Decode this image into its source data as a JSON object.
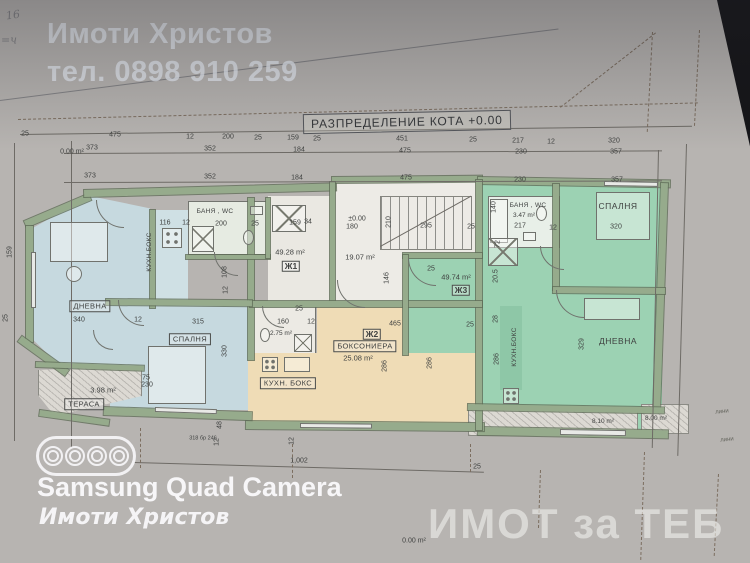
{
  "watermarks": {
    "agency": "Имоти Христов",
    "phone": "тел. 0898 910 259",
    "camera_caption": "Samsung Quad Camera",
    "camera_subcaption": "Имоти Христов",
    "corner_watermark": "ИМОТ за ТЕБ"
  },
  "colors": {
    "room_blue": "#c6d9df",
    "room_blue_light": "#cfe0e4",
    "room_green": "#9cd2b3",
    "room_green_dark": "#8ec7a7",
    "room_tan": "#efdcb6",
    "wall_sage": "#96ab8c",
    "background": "#141417"
  },
  "plan": {
    "title": "РАЗПРЕДЕЛЕНИЕ КОТА +0.00",
    "labels": [
      {
        "t": "25",
        "x": 25,
        "y": 134
      },
      {
        "t": "475",
        "x": 115,
        "y": 135
      },
      {
        "t": "12",
        "x": 190,
        "y": 137
      },
      {
        "t": "200",
        "x": 228,
        "y": 137
      },
      {
        "t": "25",
        "x": 258,
        "y": 138
      },
      {
        "t": "159",
        "x": 293,
        "y": 138
      },
      {
        "t": "25",
        "x": 317,
        "y": 139
      },
      {
        "t": "451",
        "x": 402,
        "y": 139
      },
      {
        "t": "25",
        "x": 473,
        "y": 140
      },
      {
        "t": "217",
        "x": 518,
        "y": 141
      },
      {
        "t": "12",
        "x": 551,
        "y": 142
      },
      {
        "t": "320",
        "x": 614,
        "y": 141
      },
      {
        "t": "0.00 m²",
        "x": 72,
        "y": 152
      },
      {
        "t": "373",
        "x": 92,
        "y": 148
      },
      {
        "t": "352",
        "x": 210,
        "y": 149
      },
      {
        "t": "184",
        "x": 299,
        "y": 150
      },
      {
        "t": "475",
        "x": 405,
        "y": 151
      },
      {
        "t": "230",
        "x": 521,
        "y": 152
      },
      {
        "t": "357",
        "x": 616,
        "y": 152
      },
      {
        "t": "373",
        "x": 90,
        "y": 176
      },
      {
        "t": "352",
        "x": 210,
        "y": 177
      },
      {
        "t": "184",
        "x": 297,
        "y": 178
      },
      {
        "t": "475",
        "x": 406,
        "y": 178
      },
      {
        "t": "230",
        "x": 520,
        "y": 180
      },
      {
        "t": "357",
        "x": 617,
        "y": 180
      },
      {
        "t": "116",
        "x": 165,
        "y": 223
      },
      {
        "t": "12",
        "x": 186,
        "y": 223
      },
      {
        "t": "200",
        "x": 221,
        "y": 224
      },
      {
        "t": "25",
        "x": 255,
        "y": 224
      },
      {
        "t": "159",
        "x": 295,
        "y": 223
      },
      {
        "t": "34",
        "x": 308,
        "y": 222
      },
      {
        "t": "159",
        "x": 10,
        "y": 252,
        "r": -90
      },
      {
        "t": "25",
        "x": 6,
        "y": 318,
        "r": -90
      },
      {
        "t": "БАНЯ , WC",
        "x": 215,
        "y": 212,
        "c": "rs"
      },
      {
        "t": "КУХН.БОКС",
        "x": 150,
        "y": 252,
        "r": -90,
        "c": "rs"
      },
      {
        "t": "49.28 m²",
        "x": 290,
        "y": 252,
        "c": "a"
      },
      {
        "t": "Ж1",
        "x": 291,
        "y": 266,
        "c": "ap"
      },
      {
        "t": "ДНЕВНА",
        "x": 90,
        "y": 306,
        "c": "rb"
      },
      {
        "t": "340",
        "x": 79,
        "y": 320
      },
      {
        "t": "12",
        "x": 138,
        "y": 320
      },
      {
        "t": "315",
        "x": 198,
        "y": 322
      },
      {
        "t": "СПАЛНЯ",
        "x": 190,
        "y": 339,
        "c": "rb"
      },
      {
        "t": "330",
        "x": 225,
        "y": 351,
        "r": -90
      },
      {
        "t": "108",
        "x": 225,
        "y": 272,
        "r": -90
      },
      {
        "t": "12",
        "x": 226,
        "y": 290,
        "r": -90
      },
      {
        "t": "25",
        "x": 299,
        "y": 309
      },
      {
        "t": "160",
        "x": 283,
        "y": 322
      },
      {
        "t": "12",
        "x": 311,
        "y": 322
      },
      {
        "t": "2.75 m²",
        "x": 281,
        "y": 334,
        "c": "as"
      },
      {
        "t": "±0.00",
        "x": 357,
        "y": 219
      },
      {
        "t": "180",
        "x": 352,
        "y": 227
      },
      {
        "t": "210",
        "x": 389,
        "y": 222,
        "r": -90
      },
      {
        "t": "295",
        "x": 426,
        "y": 226
      },
      {
        "t": "25",
        "x": 471,
        "y": 227
      },
      {
        "t": "140",
        "x": 494,
        "y": 207,
        "r": -90
      },
      {
        "t": "19.07 m²",
        "x": 360,
        "y": 257,
        "c": "a"
      },
      {
        "t": "146",
        "x": 387,
        "y": 278,
        "r": -90
      },
      {
        "t": "25",
        "x": 431,
        "y": 269
      },
      {
        "t": "49.74 m²",
        "x": 456,
        "y": 277,
        "c": "a"
      },
      {
        "t": "Ж3",
        "x": 461,
        "y": 290,
        "c": "ap"
      },
      {
        "t": "20.5",
        "x": 496,
        "y": 276,
        "r": -90
      },
      {
        "t": "28",
        "x": 496,
        "y": 319,
        "r": -90
      },
      {
        "t": "286",
        "x": 497,
        "y": 359,
        "r": -90
      },
      {
        "t": "465",
        "x": 395,
        "y": 324
      },
      {
        "t": "25",
        "x": 470,
        "y": 325
      },
      {
        "t": "Ж2",
        "x": 372,
        "y": 334,
        "c": "ap"
      },
      {
        "t": "БОКСОНИЕРА",
        "x": 365,
        "y": 346,
        "c": "rb"
      },
      {
        "t": "25.08 m²",
        "x": 358,
        "y": 358,
        "c": "a"
      },
      {
        "t": "286",
        "x": 385,
        "y": 366,
        "r": -90
      },
      {
        "t": "286",
        "x": 430,
        "y": 363,
        "r": -90
      },
      {
        "t": "КУХН. БОКС",
        "x": 288,
        "y": 383,
        "c": "rb"
      },
      {
        "t": "БАНЯ , WC",
        "x": 528,
        "y": 206,
        "c": "rs"
      },
      {
        "t": "3.47 m²",
        "x": 524,
        "y": 216,
        "c": "as"
      },
      {
        "t": "217",
        "x": 520,
        "y": 226
      },
      {
        "t": "СПАЛНЯ",
        "x": 618,
        "y": 206,
        "c": "r"
      },
      {
        "t": "320",
        "x": 616,
        "y": 227
      },
      {
        "t": "12",
        "x": 553,
        "y": 228
      },
      {
        "t": "72",
        "x": 498,
        "y": 244,
        "r": -90
      },
      {
        "t": "ДНЕВНА",
        "x": 618,
        "y": 341,
        "c": "r"
      },
      {
        "t": "329",
        "x": 582,
        "y": 344,
        "r": -90
      },
      {
        "t": "КУХН.БОКС",
        "x": 515,
        "y": 347,
        "r": -90,
        "c": "rs"
      },
      {
        "t": "8.10 m²",
        "x": 603,
        "y": 422,
        "c": "as"
      },
      {
        "t": "8.00 m²",
        "x": 656,
        "y": 419,
        "c": "as"
      },
      {
        "t": "ТЕРАСА",
        "x": 84,
        "y": 404,
        "c": "rb"
      },
      {
        "t": "3.98 m²",
        "x": 103,
        "y": 390,
        "c": "a"
      },
      {
        "t": "75",
        "x": 146,
        "y": 378
      },
      {
        "t": "230",
        "x": 147,
        "y": 385
      },
      {
        "t": "1,002",
        "x": 299,
        "y": 461
      },
      {
        "t": "25",
        "x": 477,
        "y": 467
      },
      {
        "t": "318 бр 246",
        "x": 203,
        "y": 439,
        "c": "tiny"
      },
      {
        "t": "48",
        "x": 220,
        "y": 425,
        "r": -90
      },
      {
        "t": "12",
        "x": 217,
        "y": 442,
        "r": -90
      },
      {
        "t": "12",
        "x": 292,
        "y": 441,
        "r": -90
      },
      {
        "t": "0.00 m²",
        "x": 414,
        "y": 541
      },
      {
        "t": "лини",
        "x": 722,
        "y": 412,
        "r": -6,
        "c": "li"
      },
      {
        "t": "лини",
        "x": 727,
        "y": 440,
        "r": -6,
        "c": "li"
      },
      {
        "t": "16",
        "x": 13,
        "y": 15,
        "r": -8,
        "c": "pc"
      },
      {
        "t": "=ч",
        "x": 9,
        "y": 40,
        "c": "pc"
      }
    ]
  }
}
